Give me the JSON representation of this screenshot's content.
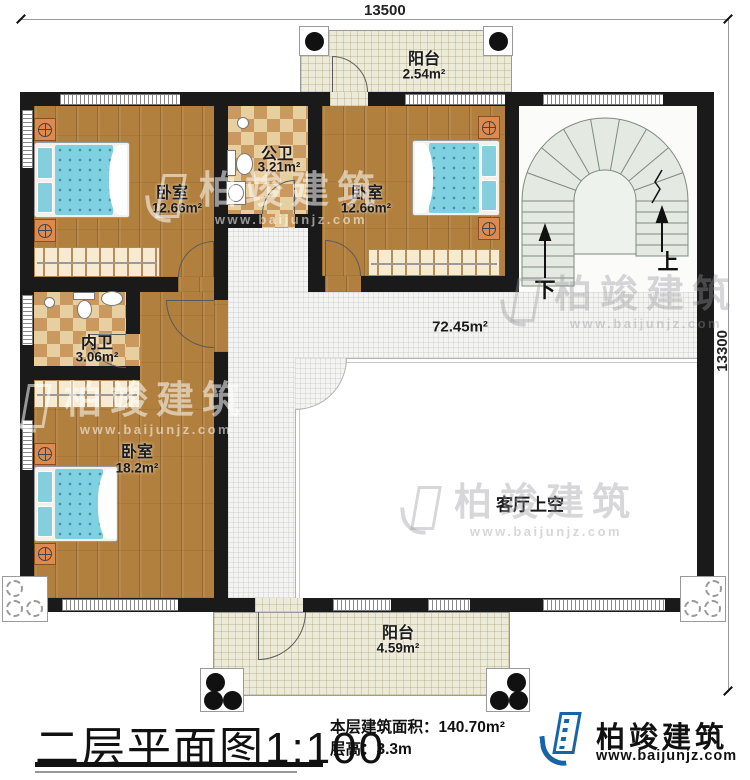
{
  "dimensions": {
    "top": "13500",
    "right": "13300"
  },
  "rooms": {
    "balcony_top": {
      "name": "阳台",
      "area": "2.54m²"
    },
    "bedroom1": {
      "name": "卧室",
      "area": "12.66m²"
    },
    "public_bath": {
      "name": "公卫",
      "area": "3.21m²"
    },
    "bedroom2": {
      "name": "卧室",
      "area": "12.66m²"
    },
    "hall": {
      "area": "72.45m²"
    },
    "ensuite_bath": {
      "name": "内卫",
      "area": "3.06m²"
    },
    "bedroom3": {
      "name": "卧室",
      "area": "18.2m²"
    },
    "living_void": {
      "name": "客厅上空"
    },
    "balcony_bottom": {
      "name": "阳台",
      "area": "4.59m²"
    }
  },
  "stairs": {
    "up_label": "上",
    "down_label": "下"
  },
  "watermark": {
    "brand": "柏竣建筑",
    "url": "www.baijunjz.com"
  },
  "title_block": {
    "title": "二层平面图",
    "scale": "1:100",
    "area_text": "本层建筑面积：140.70m²",
    "height_text": "层高：3.3m",
    "brand": "柏竣建筑",
    "url": "www.baijunjz.com"
  },
  "colors": {
    "wall": "#1a1a1a",
    "wood": "#b2803e",
    "tile-bg": "#f4f4f2",
    "balcony-bg": "#ecead9",
    "checker-a": "#e7cfa0",
    "checker-b": "#c9995f",
    "stair-fill": "#e4eae1",
    "mattress": "#7fd0e0",
    "brand-blue": "#1565a8",
    "brand-orange": "#f39200"
  }
}
